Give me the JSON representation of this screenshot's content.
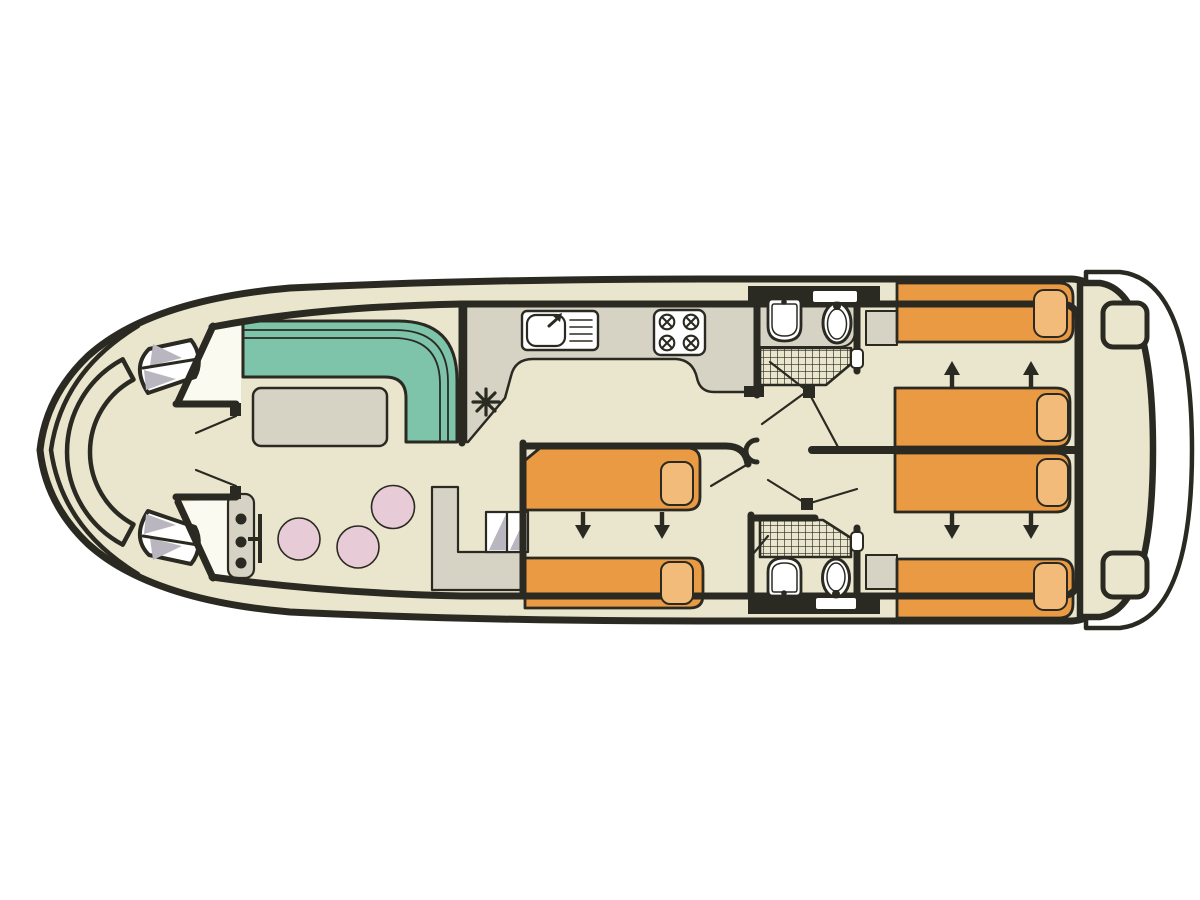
{
  "figure": {
    "kind": "canal-boat-deck-plan",
    "orientation": "bow-left-stern-right"
  },
  "colors": {
    "background": "#ffffff",
    "floor": "#eae6cd",
    "line": "#2b2a22",
    "sofa": "#7dc4ab",
    "bed": "#ea9a43",
    "pillow": "#f2bb79",
    "furniture_grey": "#d7d3c4",
    "shadow_grey": "#b9b6bf",
    "table_pink": "#e7cbd6",
    "fixture_white": "#ffffff",
    "doorway_white": "#fbfaf1"
  },
  "components": {
    "areas": [
      "bow-deck-seating",
      "helm-station",
      "saloon",
      "galley",
      "mid-guest-cabin",
      "forward-bathroom",
      "aft-bathroom",
      "aft-cabin-top",
      "aft-cabin-bottom",
      "stern-deck",
      "swim-platform"
    ],
    "symbols": [
      "bench-seat",
      "steps",
      "door-swing",
      "sofa",
      "table",
      "stool",
      "sink-with-drainer",
      "hob-4-burner",
      "heater-asterisk",
      "washbasin",
      "toilet",
      "shower-grid",
      "bed",
      "pillow",
      "sliding-bed-arrows",
      "wardrobe",
      "window"
    ]
  }
}
